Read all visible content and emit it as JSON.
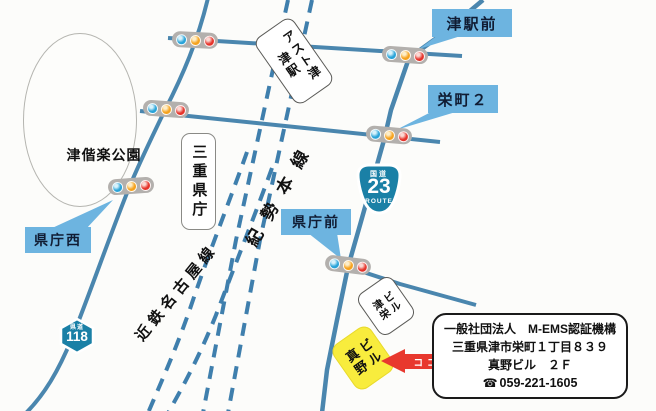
{
  "map": {
    "park": "津偕楽公園",
    "pref_office": "三重県庁",
    "station": {
      "line1": "津駅",
      "line2": "アスト津"
    },
    "rails": {
      "kisei": "紀勢本線",
      "kintetsu": "近鉄名古屋線"
    },
    "callouts": {
      "tsu_ekimae": "津駅前",
      "sakaemachi2": "栄町２",
      "kencho_nishi": "県庁西",
      "kencho_mae": "県庁前"
    },
    "route23": {
      "label": "国道",
      "number": "23",
      "route": "ROUTE"
    },
    "route118": {
      "label": "県道",
      "number": "118"
    },
    "buildings": {
      "tsuei": {
        "line1": "津栄",
        "line2": "ビル"
      },
      "mano": {
        "line1": "真野",
        "line2": "ビル"
      }
    },
    "here": "ココ",
    "info": {
      "org": "一般社団法人　M-EMS認証機構",
      "address": "三重県津市栄町１丁目８３９",
      "building_floor": "真野ビル　２Ｆ",
      "phone_icon": "☎",
      "phone": "059-221-1605"
    },
    "colors": {
      "road_blue": "#4a86ae",
      "rail_blue": "#3f7fad",
      "callout_blue": "#6db4e0",
      "signal_blue": "#29a3d8",
      "signal_yellow": "#f6a21d",
      "signal_red": "#e5332a",
      "highlight_yellow": "#f8ec3d",
      "arrow_red": "#e8382e",
      "shield_blue": "#1a80a6"
    }
  }
}
